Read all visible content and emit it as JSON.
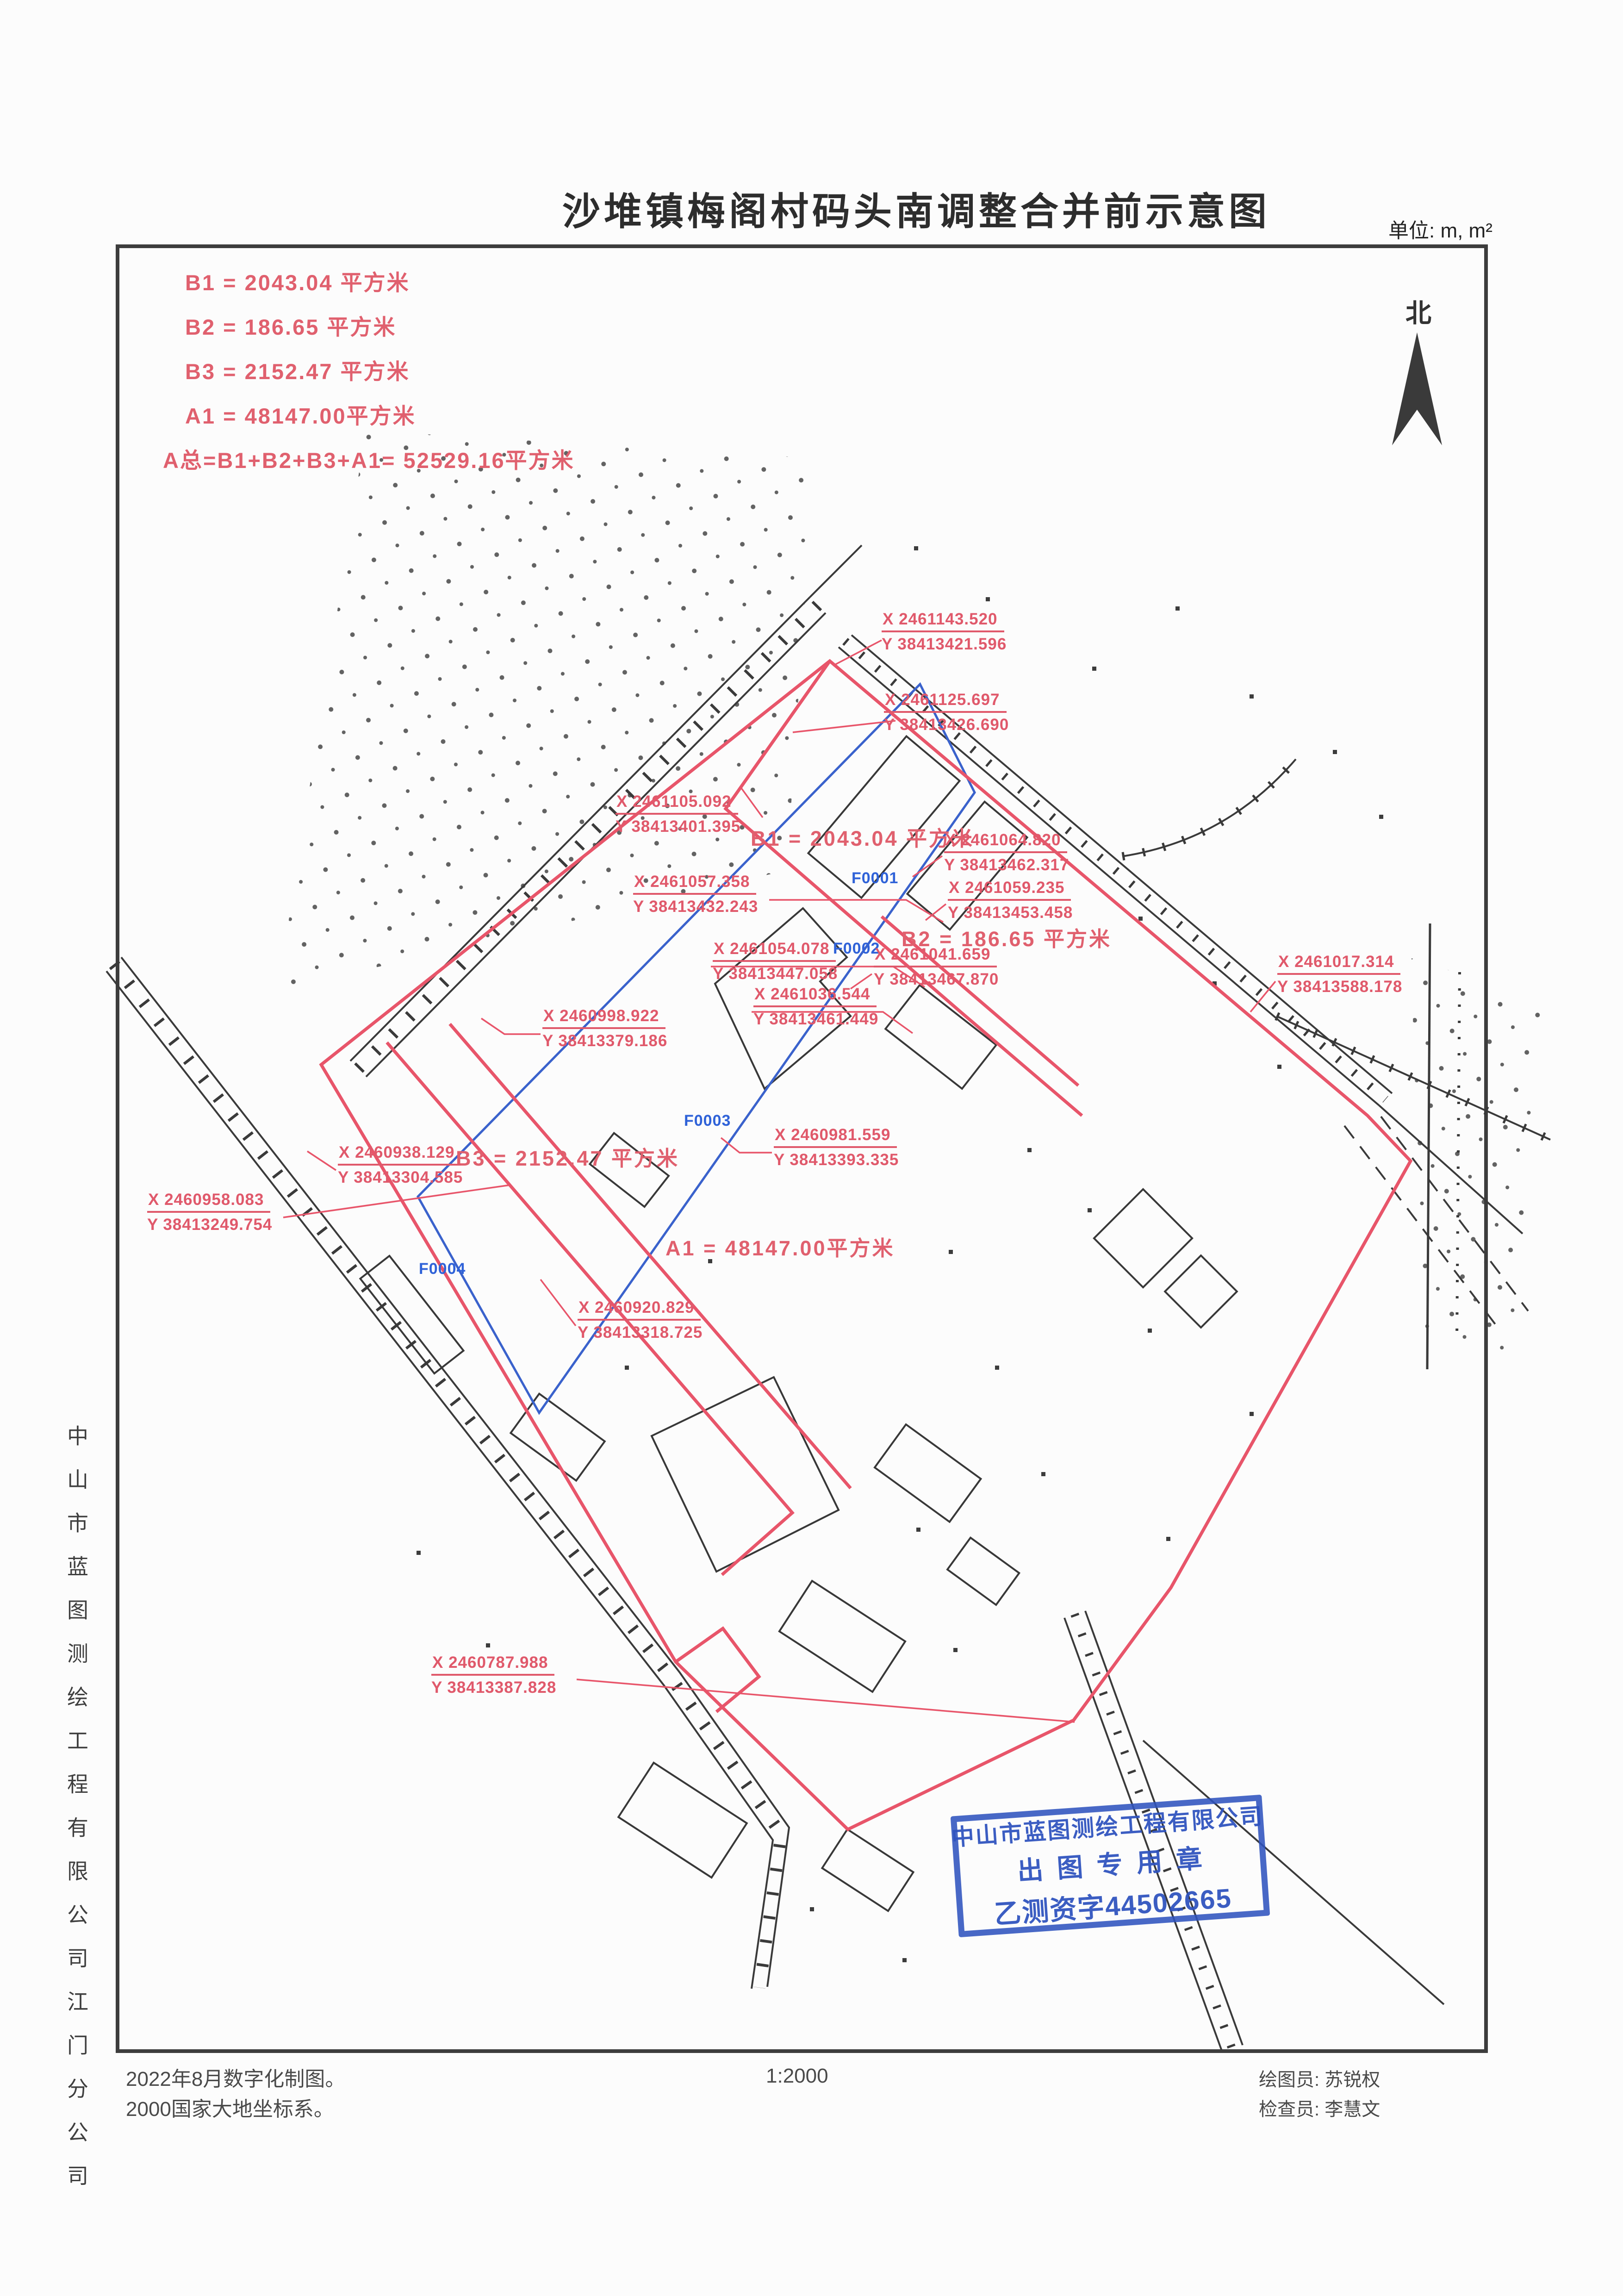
{
  "title": "沙堆镇梅阁村码头南调整合并前示意图",
  "unit_label": "单位: m, m²",
  "north": {
    "label": "北"
  },
  "area_summary": {
    "b1": "B1 = 2043.04 平方米",
    "b2": "B2 = 186.65 平方米",
    "b3": "B3 = 2152.47 平方米",
    "a1": "A1 = 48147.00平方米",
    "total": "A总=B1+B2+B3+A1= 52529.16平方米"
  },
  "map": {
    "area_labels": {
      "b1": "B1 = 2043.04 平方米",
      "b2": "B2 = 186.65 平方米",
      "b3": "B3 = 2152.47 平方米",
      "a1": "A1 = 48147.00平方米"
    },
    "parcels": {
      "f1": "F0001",
      "f2": "F0002",
      "f3": "F0003",
      "f4": "F0004"
    },
    "coords": [
      {
        "x": "X 2461143.520",
        "y": "Y 38413421.596"
      },
      {
        "x": "X 2461125.697",
        "y": "Y 38413426.690"
      },
      {
        "x": "X 2461105.092",
        "y": "Y 38413401.395"
      },
      {
        "x": "X 2461064.820",
        "y": "Y 38413462.317"
      },
      {
        "x": "X 2461057.358",
        "y": "Y 38413432.243"
      },
      {
        "x": "X 2461059.235",
        "y": "Y 38413453.458"
      },
      {
        "x": "X 2461054.078",
        "y": "Y 38413447.058"
      },
      {
        "x": "X 2461041.659",
        "y": "Y 38413467.870"
      },
      {
        "x": "X 2461036.544",
        "y": "Y 38413461.449"
      },
      {
        "x": "X 2460998.922",
        "y": "Y 38413379.186"
      },
      {
        "x": "X 2461017.314",
        "y": "Y 38413588.178"
      },
      {
        "x": "X 2460981.559",
        "y": "Y 38413393.335"
      },
      {
        "x": "X 2460938.129",
        "y": "Y 38413304.585"
      },
      {
        "x": "X 2460958.083",
        "y": "Y 38413249.754"
      },
      {
        "x": "X 2460920.829",
        "y": "Y 38413318.725"
      },
      {
        "x": "X 2460787.988",
        "y": "Y 38413387.828"
      }
    ]
  },
  "stamp": {
    "line1": "中山市蓝图测绘工程有限公司",
    "line2": "出图专用章",
    "line3": "乙测资字44502665"
  },
  "left_margin": {
    "company": "中山市蓝图测绘工程有限公司江门分公司"
  },
  "footer": {
    "note1": "2022年8月数字化制图。",
    "note2": "2000国家大地坐标系。",
    "scale": "1:2000",
    "drafter": "绘图员: 苏锐权",
    "checker": "检查员: 李慧文"
  }
}
